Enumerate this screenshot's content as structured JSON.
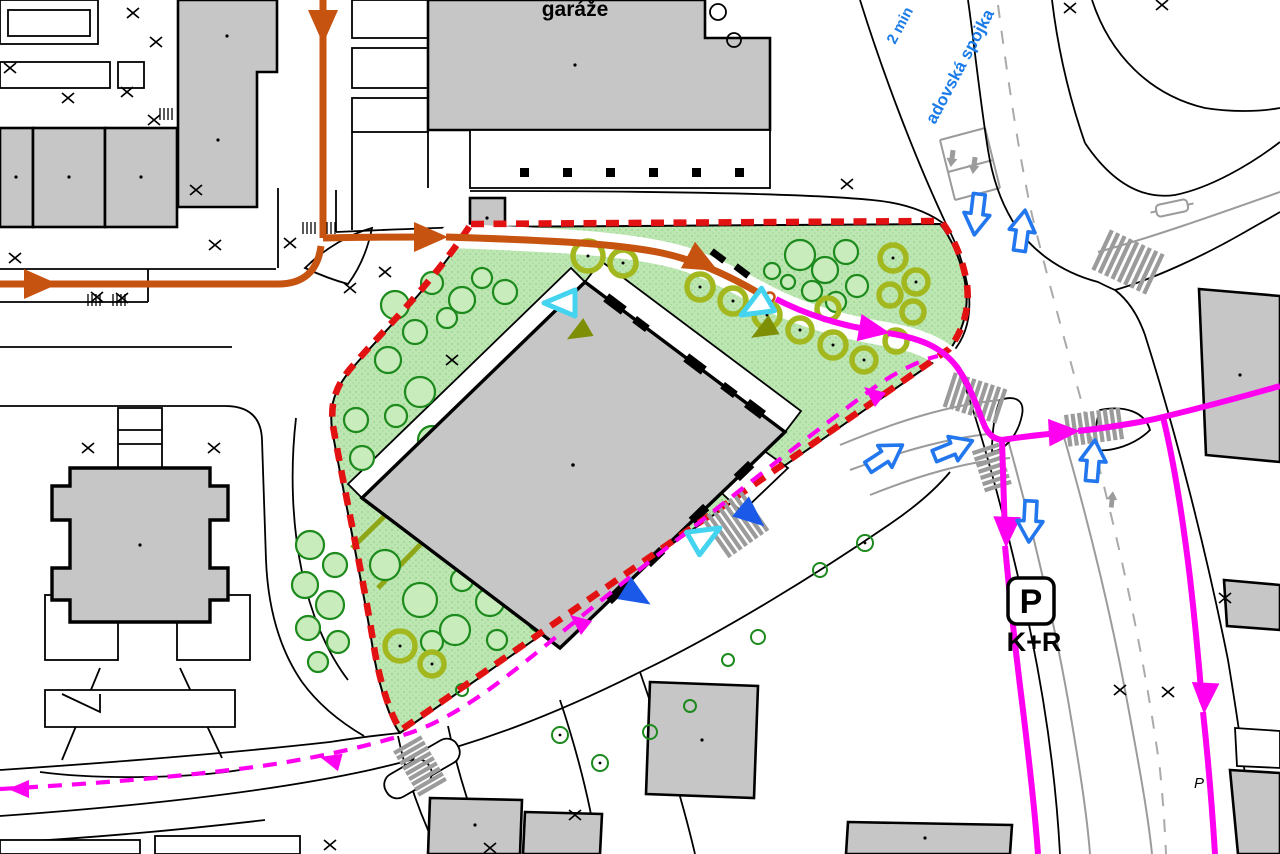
{
  "labels": {
    "garage_building": "garáže",
    "road_name": "adovská spojka",
    "walk_time": "2 min",
    "kiss_and_ride": "K+R",
    "parking_icon_letter": "P",
    "parking_spot_small": "P"
  },
  "colors": {
    "site_greenery": "#bde6b2",
    "site_boundary_red": "#e31212",
    "garage_route_orange": "#c75310",
    "transit_route_magenta": "#ff00f0",
    "traffic_arrow_blue": "#2277ee",
    "entrance_marker_cyan": "#44d4f0",
    "entrance_marker_blue": "#1b5ae8",
    "building_gray": "#c6c6c6",
    "tree_dark_green": "#1d8a1d",
    "tree_olive_green": "#a3b81e",
    "road_marking_gray": "#9b9b9b",
    "road_label_blue": "#1b7ce8"
  }
}
